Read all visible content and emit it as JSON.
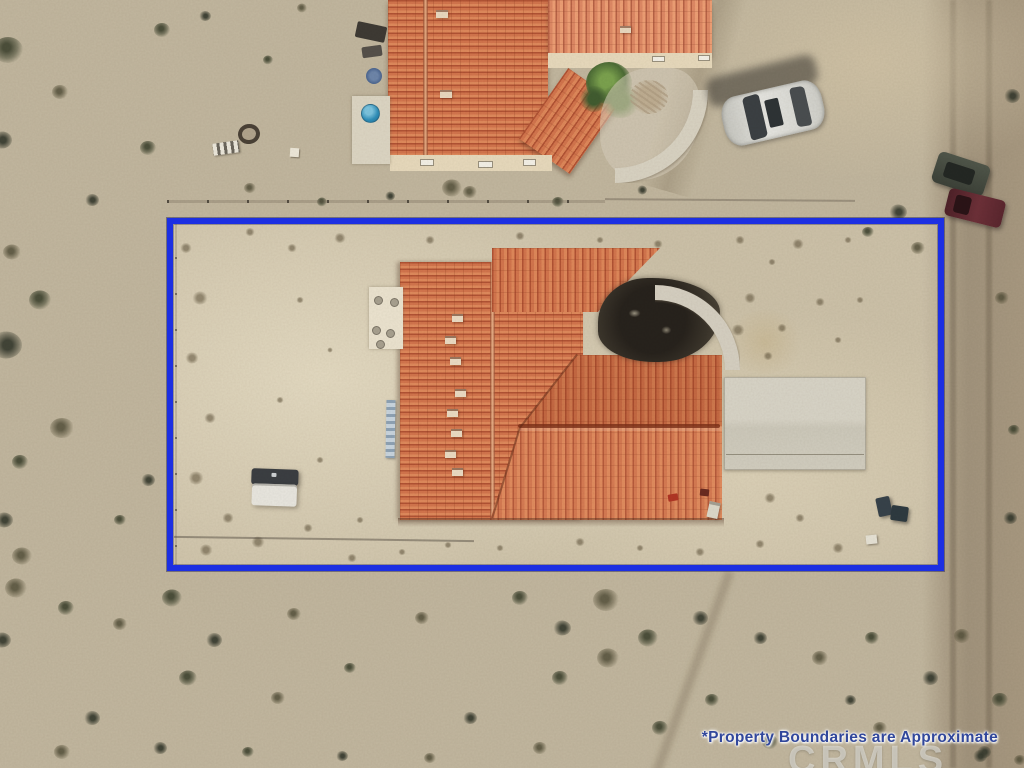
{
  "overlay": {
    "disclaimer_text": "*Property Boundaries are Approximate",
    "watermark_text": "CRMLS"
  },
  "colors": {
    "boundary": "#1c2fe2",
    "disclaimer": "#31479b",
    "watermark": "rgba(235,235,232,0.55)",
    "terracotta": "#d3754d",
    "terracotta_dark": "#7c3018",
    "concrete": "#d6d0c2",
    "sand": "#c2b79f",
    "road": "#a2947d",
    "pool_blue": "#2f8fba"
  },
  "scene": {
    "description": "Aerial drone photo of a desert property with a tile-roof house, blue approximate property-boundary rectangle, neighboring house at top, white sedan, dirt road at right, scattered scrub brush",
    "objects": [
      "subject-house-terracotta-roof",
      "neighbor-house",
      "white-sedan",
      "dark-suv",
      "maroon-truck",
      "utility-trailer",
      "concrete-driveway-pad",
      "curved-walkway",
      "dark-courtyard",
      "fire-pit-ring",
      "trash-bins",
      "chain-link-fence",
      "dirt-road",
      "blue-kiddie-pool",
      "palm-bush",
      "desert-scrub"
    ],
    "bushes": [
      [
        8,
        50,
        15
      ],
      [
        2,
        140,
        10
      ],
      [
        60,
        92,
        8
      ],
      [
        148,
        148,
        8
      ],
      [
        92,
        200,
        7
      ],
      [
        12,
        252,
        9
      ],
      [
        40,
        300,
        11
      ],
      [
        6,
        345,
        16
      ],
      [
        62,
        428,
        12
      ],
      [
        20,
        462,
        8
      ],
      [
        4,
        520,
        9
      ],
      [
        22,
        556,
        10
      ],
      [
        120,
        520,
        6
      ],
      [
        148,
        480,
        7
      ],
      [
        250,
        188,
        6
      ],
      [
        322,
        202,
        5
      ],
      [
        390,
        196,
        5
      ],
      [
        470,
        192,
        7
      ],
      [
        558,
        202,
        6
      ],
      [
        642,
        190,
        5
      ],
      [
        452,
        188,
        10
      ],
      [
        162,
        30,
        8
      ],
      [
        205,
        16,
        6
      ],
      [
        302,
        8,
        5
      ],
      [
        268,
        60,
        5
      ],
      [
        898,
        212,
        9
      ],
      [
        918,
        248,
        7
      ],
      [
        868,
        232,
        6
      ],
      [
        1012,
        96,
        8
      ],
      [
        1002,
        298,
        7
      ],
      [
        1014,
        430,
        6
      ],
      [
        1010,
        518,
        7
      ],
      [
        962,
        636,
        8
      ],
      [
        1000,
        700,
        8
      ],
      [
        984,
        752,
        7
      ],
      [
        16,
        588,
        11
      ],
      [
        66,
        608,
        8
      ],
      [
        2,
        640,
        9
      ],
      [
        120,
        624,
        7
      ],
      [
        172,
        598,
        10
      ],
      [
        214,
        640,
        8
      ],
      [
        294,
        614,
        7
      ],
      [
        188,
        678,
        9
      ],
      [
        92,
        718,
        8
      ],
      [
        278,
        698,
        7
      ],
      [
        350,
        668,
        6
      ],
      [
        160,
        748,
        7
      ],
      [
        62,
        752,
        8
      ],
      [
        248,
        752,
        6
      ],
      [
        342,
        756,
        6
      ],
      [
        422,
        618,
        7
      ],
      [
        520,
        598,
        8
      ],
      [
        562,
        628,
        9
      ],
      [
        606,
        600,
        13
      ],
      [
        648,
        638,
        10
      ],
      [
        700,
        618,
        8
      ],
      [
        608,
        658,
        11
      ],
      [
        560,
        678,
        8
      ],
      [
        470,
        718,
        7
      ],
      [
        540,
        748,
        7
      ],
      [
        660,
        728,
        8
      ],
      [
        760,
        638,
        7
      ],
      [
        820,
        658,
        8
      ],
      [
        872,
        638,
        7
      ],
      [
        930,
        678,
        8
      ],
      [
        880,
        728,
        7
      ],
      [
        770,
        742,
        8
      ],
      [
        980,
        756,
        7
      ],
      [
        430,
        758,
        6
      ],
      [
        712,
        700,
        7
      ],
      [
        850,
        700,
        6
      ],
      [
        1020,
        760,
        6
      ]
    ],
    "speckles": [
      [
        186,
        248,
        6
      ],
      [
        200,
        298,
        8
      ],
      [
        192,
        358,
        7
      ],
      [
        210,
        418,
        6
      ],
      [
        196,
        478,
        8
      ],
      [
        228,
        518,
        6
      ],
      [
        258,
        542,
        7
      ],
      [
        308,
        528,
        5
      ],
      [
        206,
        550,
        7
      ],
      [
        250,
        232,
        5
      ],
      [
        292,
        248,
        5
      ],
      [
        340,
        238,
        6
      ],
      [
        430,
        240,
        5
      ],
      [
        520,
        236,
        5
      ],
      [
        600,
        240,
        4
      ],
      [
        658,
        244,
        5
      ],
      [
        740,
        240,
        5
      ],
      [
        798,
        244,
        6
      ],
      [
        848,
        240,
        4
      ],
      [
        772,
        262,
        4
      ],
      [
        750,
        298,
        6
      ],
      [
        782,
        328,
        5
      ],
      [
        820,
        302,
        5
      ],
      [
        838,
        340,
        4
      ],
      [
        860,
        300,
        4
      ],
      [
        738,
        330,
        7
      ],
      [
        768,
        356,
        5
      ],
      [
        300,
        300,
        4
      ],
      [
        330,
        350,
        3
      ],
      [
        280,
        400,
        4
      ],
      [
        320,
        460,
        4
      ],
      [
        360,
        520,
        4
      ],
      [
        770,
        498,
        6
      ],
      [
        800,
        518,
        5
      ],
      [
        838,
        548,
        6
      ],
      [
        760,
        544,
        5
      ],
      [
        700,
        552,
        5
      ],
      [
        640,
        548,
        4
      ],
      [
        580,
        542,
        5
      ],
      [
        352,
        558,
        5
      ],
      [
        402,
        552,
        4
      ],
      [
        448,
        545,
        4
      ],
      [
        500,
        548,
        4
      ]
    ]
  }
}
